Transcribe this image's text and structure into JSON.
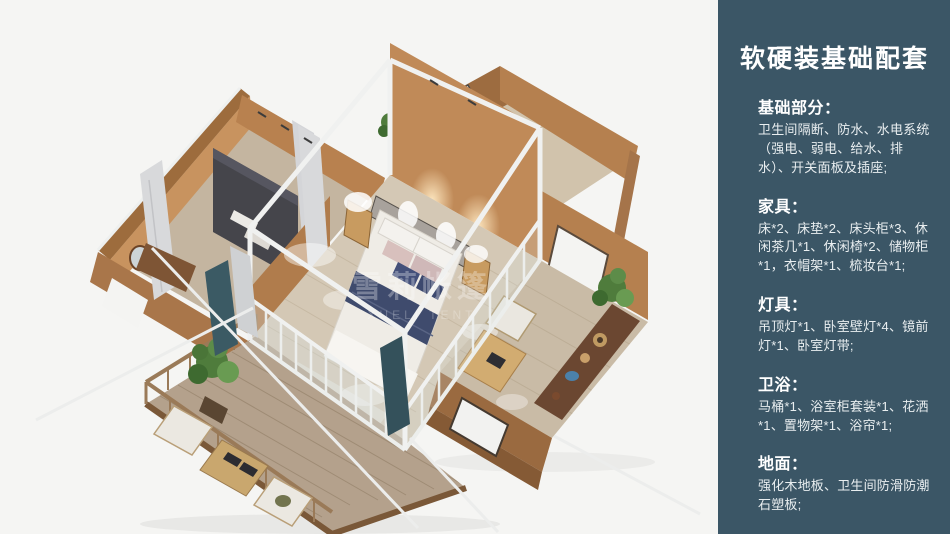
{
  "panel": {
    "background": "#3b5666",
    "text_color": "#e9eef0",
    "title": "软硬装基础配套",
    "sections": [
      {
        "heading": "基础部分：",
        "body": "卫生间隔断、防水、水电系统（强电、弱电、给水、排水）、开关面板及插座;"
      },
      {
        "heading": "家具：",
        "body": "床*2、床垫*2、床头柜*3、休闲茶几*1、休闲椅*2、储物柜*1，衣帽架*1、梳妆台*1;"
      },
      {
        "heading": "灯具：",
        "body": "吊顶灯*1、卧室壁灯*4、镜前灯*1、卧室灯带;"
      },
      {
        "heading": "卫浴：",
        "body": "马桶*1、浴室柜套装*1、花洒*1、置物架*1、浴帘*1;"
      },
      {
        "heading": "地面：",
        "body": "强化木地板、卫生间防滑防潮石塑板;"
      }
    ]
  },
  "render": {
    "watermark_cn": "雪莉帐篷",
    "watermark_en": "XUELI TENT",
    "palette": {
      "background": "#f5f5f3",
      "wall_tan_outer": "#9d6c40",
      "wall_tan_lit": "#b5804f",
      "wall_tan_inner": "#c8935f",
      "floor_wood": "#d4c8b5",
      "deck_wood": "#b4a18c",
      "frame_white": "#eceeec",
      "bed_navy": "#3f4b6d",
      "plant_green": "#4f7c3c",
      "curtain_teal": "#3b5a64",
      "sideboard_brown": "#6b4731"
    }
  }
}
